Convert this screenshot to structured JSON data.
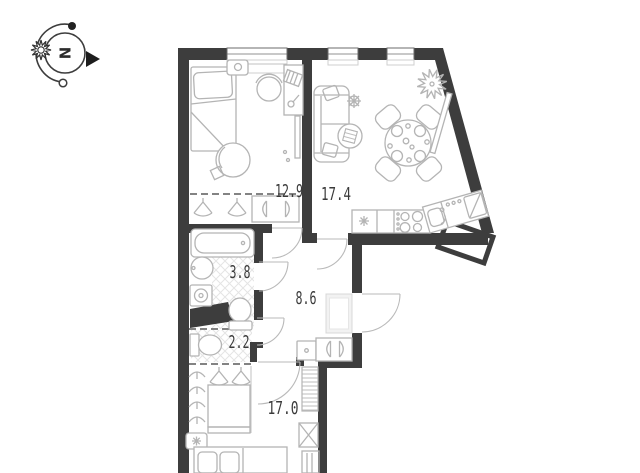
{
  "compass": {
    "north_label": "N"
  },
  "rooms": [
    {
      "id": "bedroom-1",
      "area_label": "12.9"
    },
    {
      "id": "living-kitchen",
      "area_label": "17.4"
    },
    {
      "id": "bathroom",
      "area_label": "3.8"
    },
    {
      "id": "hallway",
      "area_label": "8.6"
    },
    {
      "id": "wc",
      "area_label": "2.2"
    },
    {
      "id": "bedroom-2",
      "area_label": "17.0"
    }
  ],
  "colors": {
    "wall": "#3d3d3d",
    "furniture": "#b4b4b4",
    "tile": "#e4e4e4",
    "label": "#3a3a3a",
    "background": "#ffffff"
  }
}
